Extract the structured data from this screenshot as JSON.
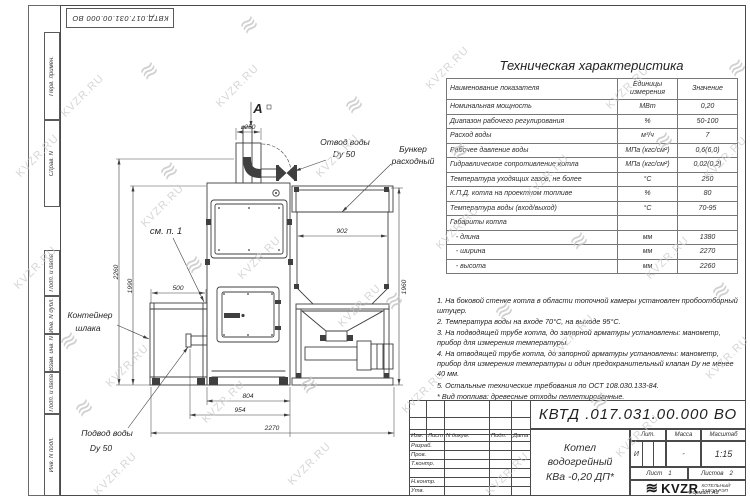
{
  "watermark": {
    "text": "KVZR.RU",
    "logo_glyph": "≋"
  },
  "frame": {
    "doc_number_top": "КВТД.017.031.00.000 ВО",
    "left_labels_upper": [
      "Перв. примен.",
      "Справ. N"
    ],
    "left_labels_lower": [
      "Подп. и дата",
      "Инв. N дубл.",
      "Взам. инв. N",
      "Подп. и дата",
      "Инв. N подл."
    ],
    "format_note": "Формат А3"
  },
  "spec_table": {
    "title": "Техническая характеристика",
    "headers": [
      "Наименование показателя",
      "Единицы измерения",
      "Значение"
    ],
    "rows": [
      {
        "name": "Номинальная мощность",
        "unit": "МВт",
        "value": "0,20"
      },
      {
        "name": "Диапазон рабочего регулирования",
        "unit": "%",
        "value": "50-100"
      },
      {
        "name": "Расход воды",
        "unit": "м³/ч",
        "value": "7"
      },
      {
        "name": "Рабочее давление воды",
        "unit": "МПа (кгс/см²)",
        "value": "0,6(6,0)"
      },
      {
        "name": "Гидравлическое сопротивление котла",
        "unit": "МПа (кгс/см²)",
        "value": "0,02(0,2)"
      },
      {
        "name": "Температура уходящих газов, не более",
        "unit": "°С",
        "value": "250"
      },
      {
        "name": "К.П.Д. котла на проектном топливе",
        "unit": "%",
        "value": "80"
      },
      {
        "name": "Температура воды (вход/выход)",
        "unit": "°С",
        "value": "70-95"
      },
      {
        "name": "Габариты котла",
        "unit": "",
        "value": ""
      },
      {
        "name": "   - длина",
        "unit": "мм",
        "value": "1380"
      },
      {
        "name": "   - ширина",
        "unit": "мм",
        "value": "2270"
      },
      {
        "name": "   - высота",
        "unit": "мм",
        "value": "2260"
      }
    ]
  },
  "notes": [
    "1. На боковой стенке котла в области топочной камеры установлен пробоотборный штуцер.",
    "2. Температура воды на входе 70°С, на выходе 95°С.",
    "3. На подводящей трубе котла, до запорной арматуры установлены: манометр, прибор для измерения температуры.",
    "4. На отводящей трубе котла, до запорной арматуры установлены: манометр, прибор для измерения температуры и один предохранительный клапан Dу не менее 40 мм.",
    "5. Остальные технические требования по ОСТ 108.030.133-84."
  ],
  "fuel_note": "* Вид топлива: древесные отходы пеллетированные.",
  "title_block": {
    "doc_number": "КВТД .017.031.00.000  ВО",
    "product_name_line1": "Котел водогрейный",
    "product_name_line2": "КВа -0,20  ДП*",
    "header_cells": [
      "Изм.",
      "Лист",
      "N докум.",
      "Подп.",
      "Дата"
    ],
    "row_labels": [
      "Разраб.",
      "Пров.",
      "Т.контр.",
      "",
      "Н.контр.",
      "Утв."
    ],
    "lit_label": "Лит.",
    "lit_value": "И",
    "mass_label": "Масса",
    "mass_value": "-",
    "scale_label": "Масштаб",
    "scale_value": "1:15",
    "sheet_label": "Лист",
    "sheet_value": "1",
    "sheets_label": "Листов",
    "sheets_value": "2",
    "logo_text": "KVZR",
    "company_line1": "КОТЕЛЬНЫЙ",
    "company_line2": "ЗАВОД РЭП"
  },
  "drawing": {
    "labels": {
      "view_arrow": "А",
      "outlet_line1": "Отвод воды",
      "outlet_line2": "Dy 50",
      "hopper_line1": "Бункер",
      "hopper_line2": "расходный",
      "see_note": "см. п. 1",
      "container_line1": "Контейнер",
      "container_line2": "шлака",
      "inlet_line1": "Подвод воды",
      "inlet_line2": "Dy 50"
    },
    "dims": {
      "chimney": "⌀250",
      "hopper_width": "902",
      "container_width": "500",
      "boiler_width": "804",
      "base_width": "954",
      "total_width": "2270",
      "total_height": "2260",
      "boiler_height": "1990",
      "hopper_height": "1960"
    }
  }
}
